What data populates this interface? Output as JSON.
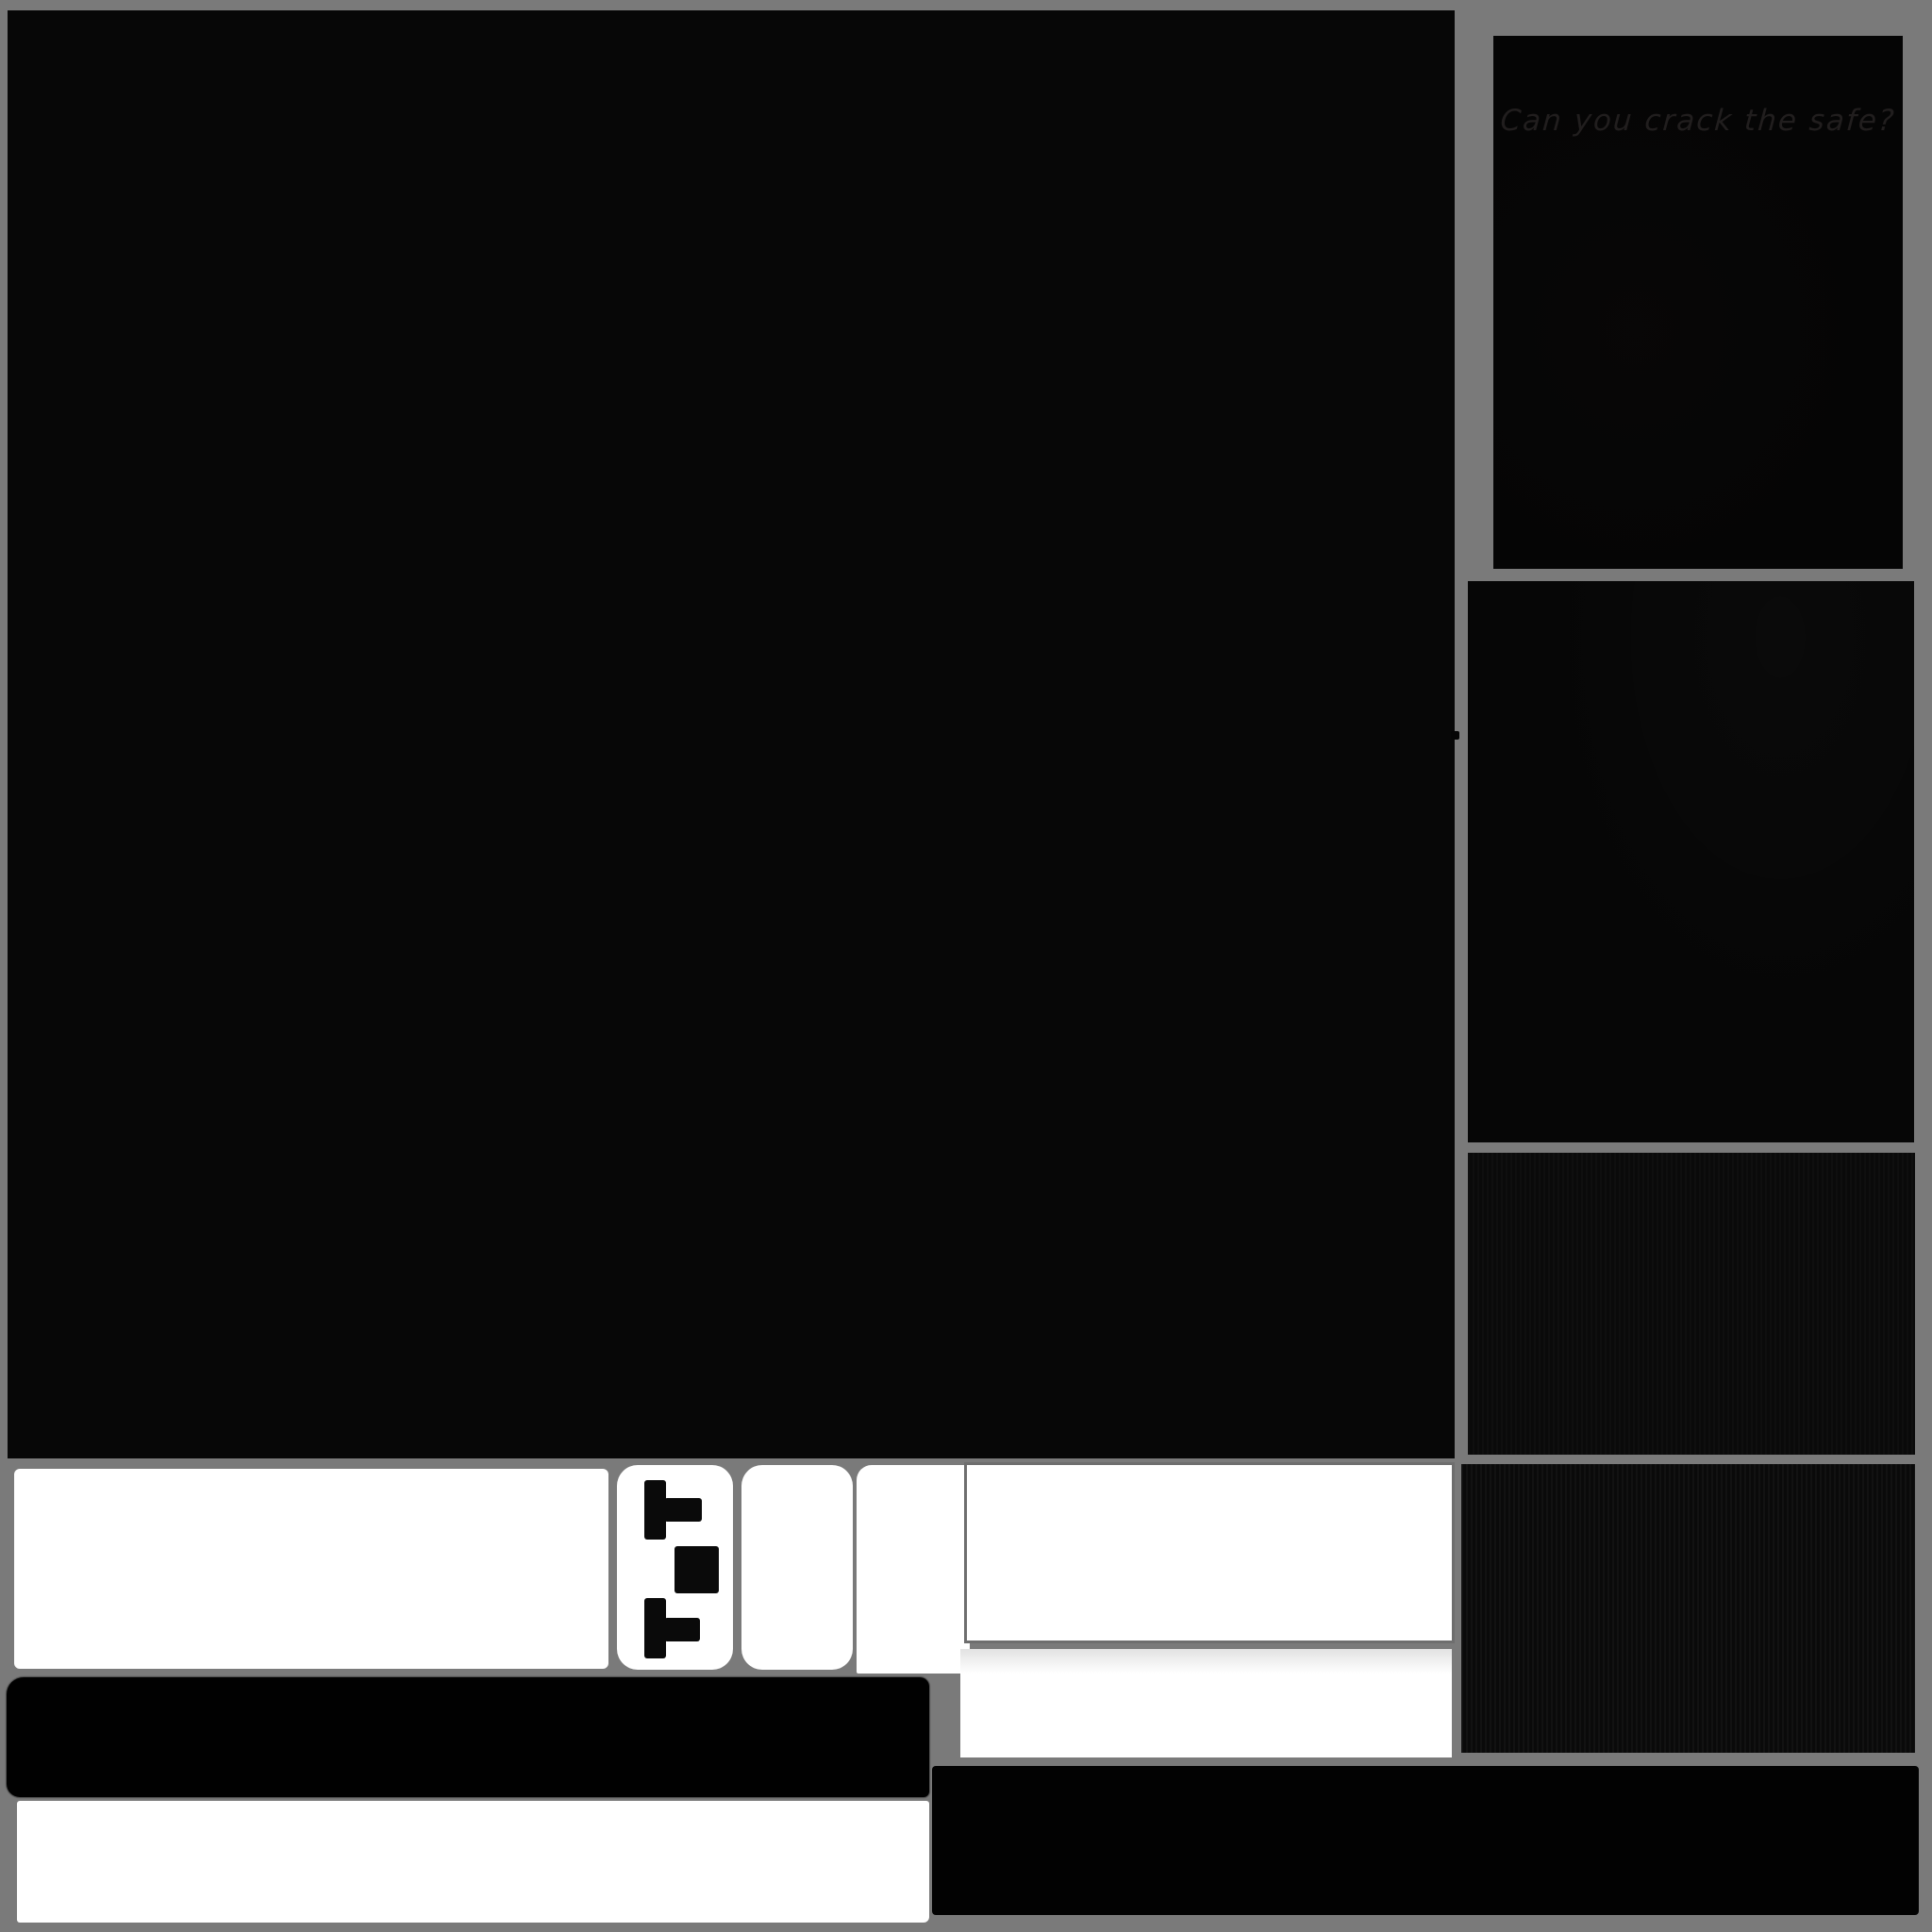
{
  "canvas": {
    "background_color": "#7a7a7a",
    "panel_black": "#070707",
    "card_white": "#ffffff",
    "wide_panel_border_color": "#6e6e6e",
    "riddle_text_color": "#211e1e"
  },
  "panels": {
    "riddle_text": "Can you crack the safe?"
  },
  "icons": {
    "t_piece_top": "t-tetromino pointing right",
    "square_piece": "black square",
    "t_piece_bottom": "t-tetromino pointing right"
  }
}
